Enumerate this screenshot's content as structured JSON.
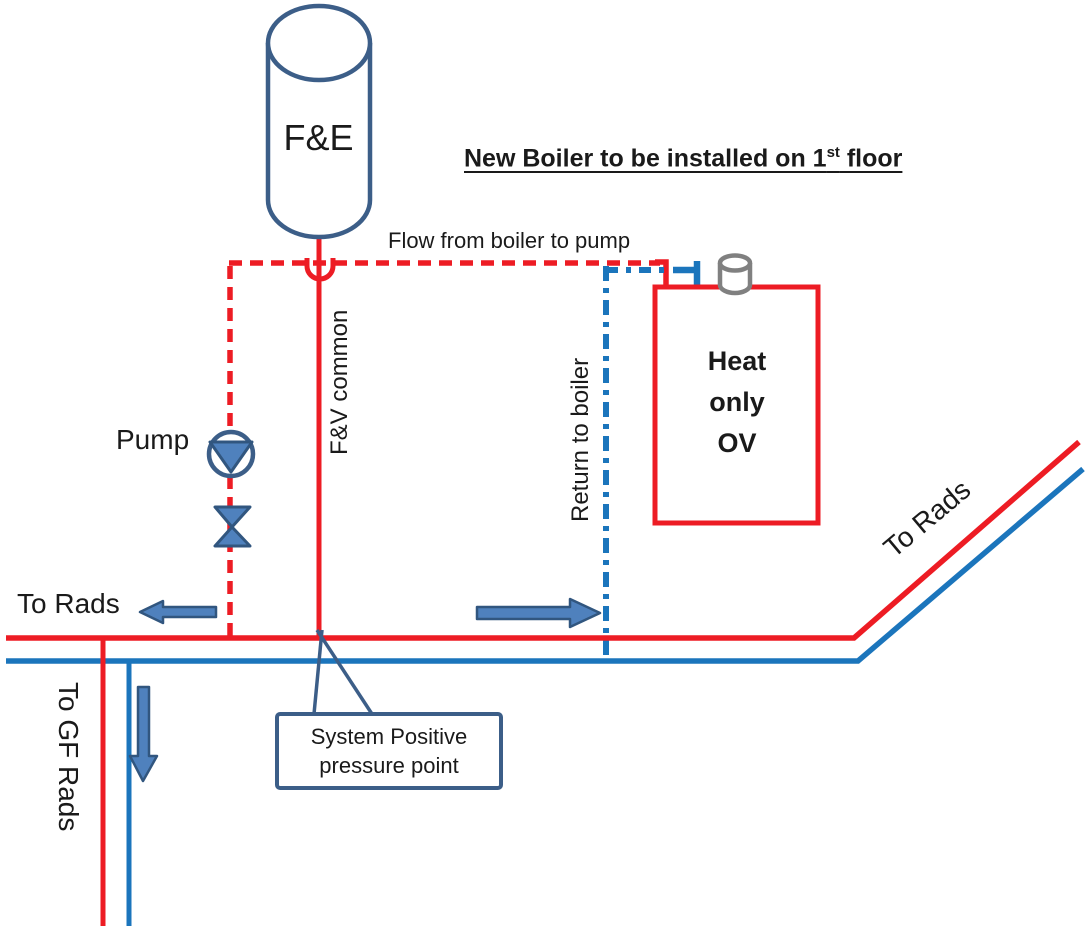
{
  "diagram": {
    "title": {
      "text_before_sup": "New Boiler to be installed on 1",
      "superscript": "st",
      "text_after_sup": " floor"
    },
    "tank_label": "F&E",
    "flow_label": "Flow from boiler to pump",
    "fv_common_label": "F&V common",
    "return_label": "Return to boiler",
    "pump_label": "Pump",
    "to_rads_left_label": "To Rads",
    "to_rads_right_label": "To Rads",
    "to_gf_rads_label": "To GF Rads",
    "boiler": {
      "line1": "Heat",
      "line2": "only",
      "line3": "OV"
    },
    "callout": {
      "line1": "System Positive",
      "line2": "pressure point"
    }
  },
  "colors": {
    "flow_pipe_red": "#ED1C24",
    "return_pipe_blue": "#1B75BC",
    "shape_fill_blue": "#4F81BD",
    "shape_border_dark": "#31567F",
    "outline_steel_blue": "#3C5E88",
    "flue_gray": "#808080",
    "text_black": "#1A1A1A"
  }
}
